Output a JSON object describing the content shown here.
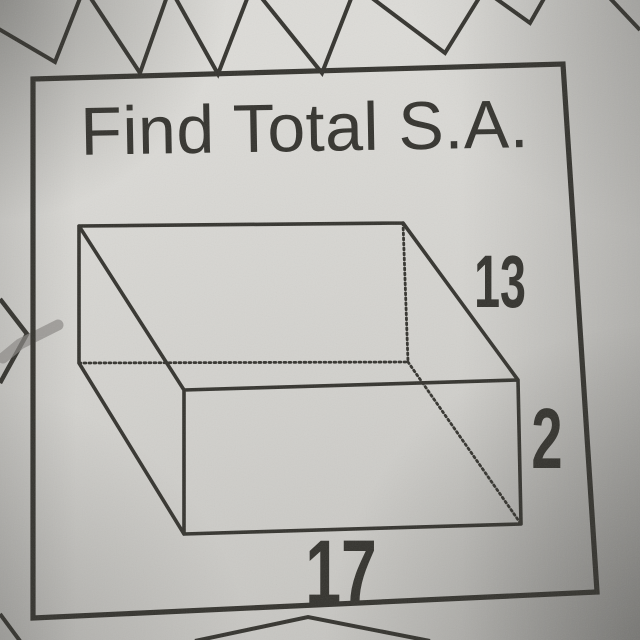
{
  "problem": {
    "title": "Find Total S.A.",
    "figure": "rectangular prism",
    "dimensions": {
      "slant_depth": "13",
      "height": "2",
      "length": "17"
    }
  },
  "colors": {
    "paper": "#d7d6d2",
    "ink": "#34332e",
    "pencil": "#8a8884"
  }
}
